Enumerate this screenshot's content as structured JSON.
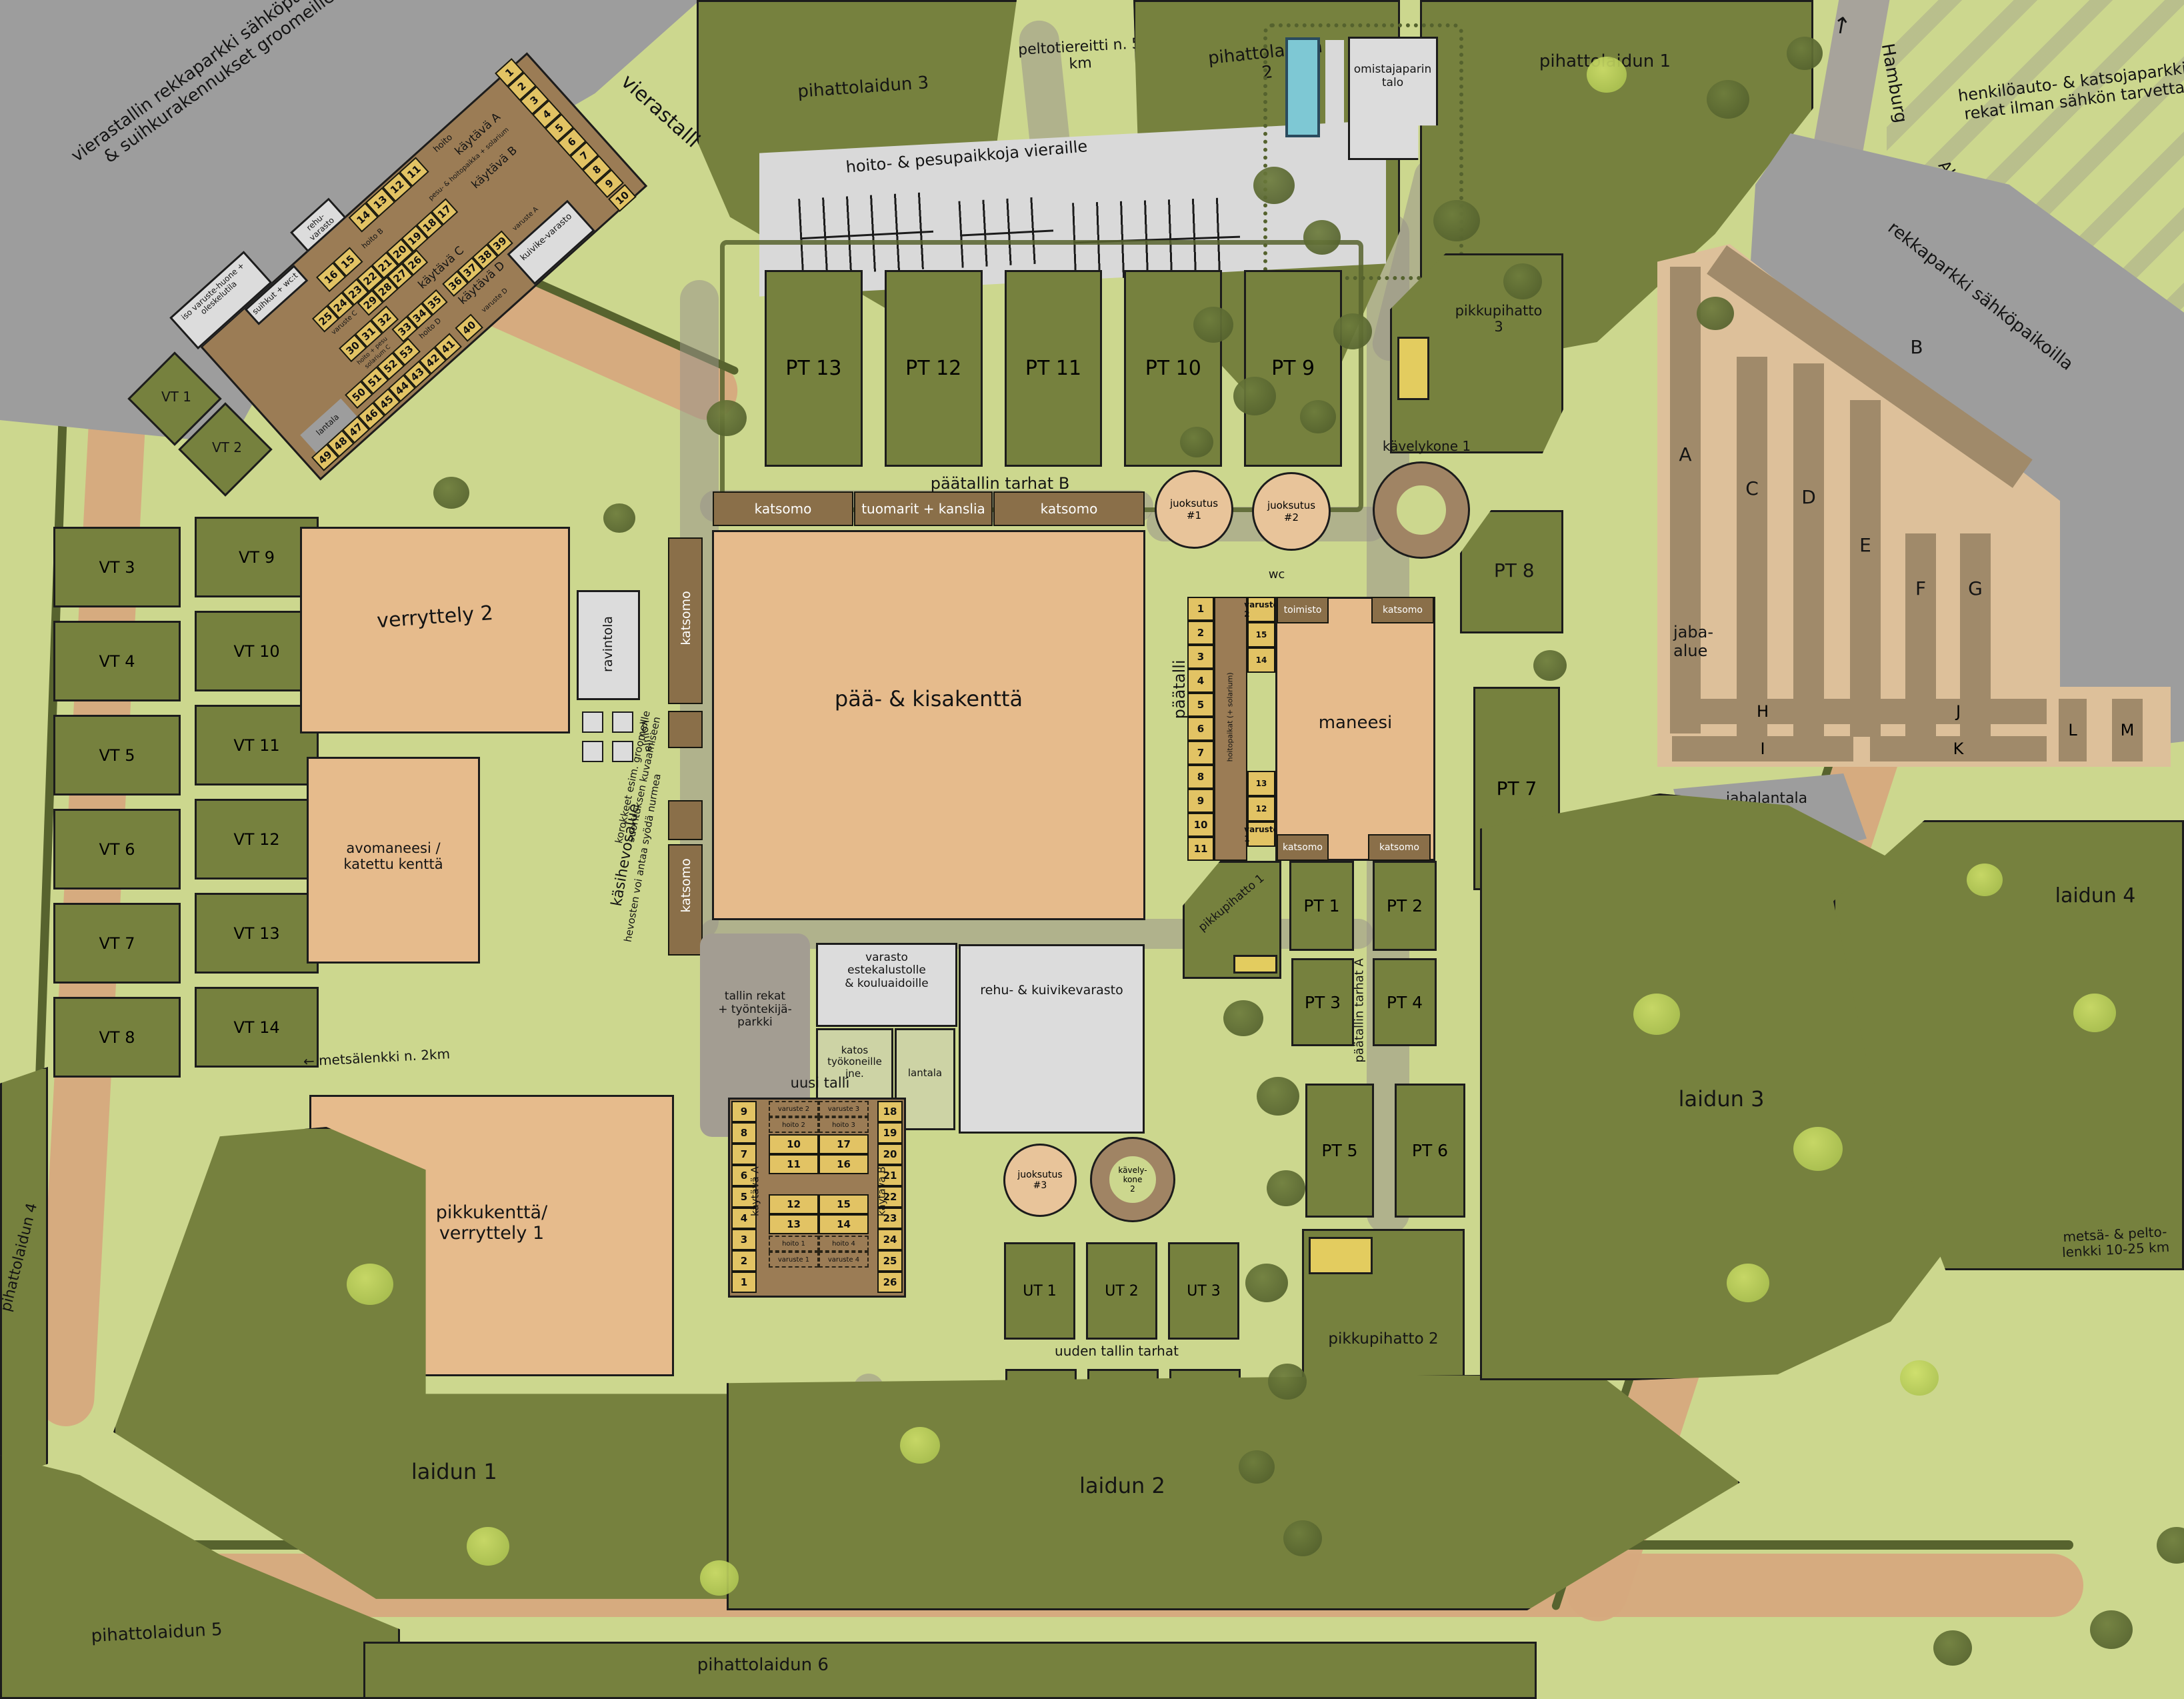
{
  "nw_parking": {
    "label": "vierastallin rekkaparkki sähköpaikkoineen & suihkurakennukset groomeille jne"
  },
  "vierastalli": {
    "name": "vierastalli",
    "kaytava_a": "käytävä A",
    "kaytava_b": "käytävä B",
    "kaytava_c": "käytävä C",
    "kaytava_d": "käytävä D",
    "pesu_hoito": "pesu- & hoitopaikka + solarium",
    "iso_varustehuone": "iso varuste-huone + oleskelutila",
    "suihkut": "suihkut + wc:t",
    "rehuvarasto": "rehu-varasto",
    "kuivikevarasto": "kuivike-varasto",
    "lantala_1": "lantala",
    "hoito": "hoito",
    "hoito_b": "hoito B",
    "hoito_d": "hoito D",
    "hoito_pesu": "hoito + pesu",
    "solarium_c": "solarium C",
    "varuste_a": "varuste A",
    "varuste_c": "varuste C",
    "varuste_d": "varuste D",
    "row_a": [
      "1",
      "2",
      "3",
      "4",
      "5",
      "6",
      "7",
      "8",
      "9"
    ],
    "stall_10": "10",
    "stall_40": "40",
    "row_top": [
      "14",
      "13",
      "12",
      "11"
    ],
    "row_b1": [
      "16",
      "15"
    ],
    "row_b2": [
      "25",
      "24",
      "23",
      "22",
      "21",
      "20",
      "19",
      "18",
      "17"
    ],
    "row_b3": [
      "29",
      "28",
      "27",
      "26"
    ],
    "row_c1": [
      "30",
      "31",
      "32"
    ],
    "row_c2": [
      "33",
      "34",
      "35"
    ],
    "row_c3": [
      "36",
      "37",
      "38",
      "39"
    ],
    "row_d1": [
      "50",
      "51",
      "52",
      "53"
    ],
    "row_d2": [
      "49",
      "48",
      "47",
      "46",
      "45",
      "44",
      "43",
      "42",
      "41"
    ]
  },
  "vt": {
    "vt1": "VT 1",
    "vt2": "VT 2",
    "col1": [
      "VT 3",
      "VT 4",
      "VT 5",
      "VT 6",
      "VT 7",
      "VT 8"
    ],
    "col2": [
      "VT 9",
      "VT 10",
      "VT 11",
      "VT 12",
      "VT 13",
      "VT 14"
    ]
  },
  "top": {
    "pihattolaidun3": "pihattolaidun 3",
    "peltotie": "peltotiereitti n. 5 km",
    "pihattolaidun2a": "pihattolaidun",
    "pihattolaidun2b": "2",
    "pesupaikat": "hoito- & pesupaikkoja vieraille",
    "talo_1": "omistajaparin",
    "talo_2": "talo",
    "pihattolaidun1": "pihattolaidun 1"
  },
  "roads": {
    "hamburg": "Hamburg",
    "hamburg_arrow": "↑",
    "alt_konigsweg": "Alt Königsweg",
    "luneburg": "Lüneburg→",
    "henkiloparkki_1": "henkilöauto- & katsojaparkki",
    "henkiloparkki_2": "rekat ilman sähkön tarvetta",
    "rekkaparkki": "rekkaparkki sähköpaikoilla"
  },
  "jaba": {
    "alue_1": "jaba-",
    "alue_2": "alue",
    "a": "A",
    "b": "B",
    "c": "C",
    "d": "D",
    "e": "E",
    "f": "F",
    "g": "G",
    "h": "H",
    "i": "I",
    "j": "J",
    "k": "K",
    "l": "L",
    "m": "M",
    "jabalantala": "jabalantala"
  },
  "pt_b": {
    "label": "päätallin tarhat B",
    "items": [
      "PT 13",
      "PT 12",
      "PT 11",
      "PT 10",
      "PT 9"
    ]
  },
  "pikkupihatto": {
    "p1": "pikkupihatto 1",
    "p2": "pikkupihatto 2",
    "p3_1": "pikkupihatto",
    "p3_2": "3"
  },
  "circles": {
    "j1a": "juoksutus",
    "j1b": "#1",
    "j2a": "juoksutus",
    "j2b": "#2",
    "j3a": "juoksutus",
    "j3b": "#3",
    "k1": "kävelykone 1",
    "k2a": "kävely-",
    "k2b": "kone",
    "k2c": "2",
    "wc": "wc"
  },
  "kentta": {
    "paa": "pää- & kisakenttä",
    "katsomo_left": "katsomo",
    "tuomarit": "tuomarit + kanslia",
    "katsomo_right": "katsomo",
    "katsomo_v1": "katsomo",
    "katsomo_v2": "katsomo",
    "verryttely2": "verryttely 2",
    "avomaneesi_1": "avomaneesi /",
    "avomaneesi_2": "katettu kenttä",
    "ravintola": "ravintola",
    "kojuja": "kojuja",
    "kasihevos_1": "käsihevosalue",
    "kasihevos_2": "hevosten voi antaa syödä nurmea",
    "korokkeet": "korokkeet esim. groomeille suorituksen kuvaamiseen"
  },
  "paatalli": {
    "label": "päätalli",
    "stalls": [
      "1",
      "2",
      "3",
      "4",
      "5",
      "6",
      "7",
      "8",
      "9",
      "10",
      "11"
    ],
    "aisle": "hoitopaikat (+ solarium)",
    "right_top": [
      "varuste 2",
      "15",
      "14"
    ],
    "right_bot": [
      "13",
      "12",
      "varuste 1"
    ],
    "toimisto": "toimisto",
    "maneesi": "maneesi",
    "katsomo_tr": "katsomo",
    "katsomo_bl": "katsomo",
    "katsomo_br": "katsomo"
  },
  "varastot": {
    "tallin_rekat_1": "tallin rekat",
    "tallin_rekat_2": "+ työntekijä-",
    "tallin_rekat_3": "parkki",
    "varasto_1": "varasto",
    "varasto_2": "estekalustolle",
    "varasto_3": "& kouluaidoille",
    "katos_1": "katos",
    "katos_2": "työkoneille",
    "katos_3": "jne.",
    "lantala": "lantala",
    "rehu": "rehu- & kuivikevarasto"
  },
  "uusi_talli": {
    "label": "uusi talli",
    "left": [
      "9",
      "8",
      "7",
      "6",
      "5",
      "4",
      "3",
      "2",
      "1"
    ],
    "right": [
      "18",
      "19",
      "20",
      "21",
      "22",
      "23",
      "24",
      "25",
      "26"
    ],
    "kaytava_a": "käytävä A",
    "kaytava_b": "käytävä B",
    "r_varuste_top": [
      "varuste 2",
      "varuste 3"
    ],
    "r_hoito_top": [
      "hoito 2",
      "hoito 3"
    ],
    "r1": [
      "10",
      "17"
    ],
    "r2": [
      "11",
      "16"
    ],
    "r3": [
      "12",
      "15"
    ],
    "r4": [
      "13",
      "14"
    ],
    "r_hoito_bot": [
      "hoito 1",
      "hoito 4"
    ],
    "r_varuste_bot": [
      "varuste 1",
      "varuste 4"
    ]
  },
  "ut": {
    "label": "uuden tallin tarhat",
    "row1": [
      "UT 1",
      "UT 2",
      "UT 3"
    ],
    "row2": [
      "UT 4",
      "UT 5",
      "UT"
    ]
  },
  "pt_a": {
    "label": "päätallin tarhat A",
    "pt1": "PT 1",
    "pt2": "PT 2",
    "pt3": "PT 3",
    "pt4": "PT 4",
    "pt5": "PT 5",
    "pt6": "PT 6",
    "pt7": "PT 7",
    "pt8": "PT 8"
  },
  "pastures": {
    "laidun1": "laidun 1",
    "laidun2": "laidun 2",
    "laidun3": "laidun 3",
    "laidun4": "laidun 4",
    "pihattolaidun4": "pihattolaidun 4",
    "pihattolaidun5": "pihattolaidun 5",
    "pihattolaidun6": "pihattolaidun 6"
  },
  "trails": {
    "metsalenkki": "← metsälenkki n. 2km",
    "metsa_pelto_1": "metsä- & pelto-",
    "metsa_pelto_2": "lenkki 10-25 km"
  }
}
